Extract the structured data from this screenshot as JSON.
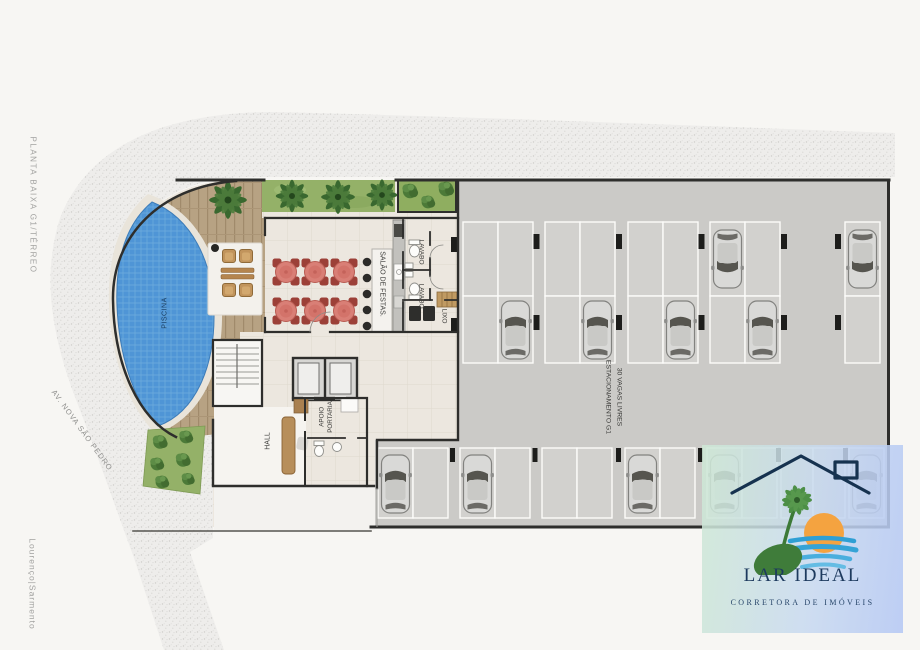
{
  "annotations": {
    "plan_title": "PLANTA BAIXA G1/TÉRREO",
    "credit": "Lourenço|Sarmento",
    "street_name": "AV. NOVA SÃO PEDRO"
  },
  "rooms": {
    "pool_label": "PISCINA",
    "party_room_label": "SALÃO DE FESTAS.",
    "lavabo1_label": "LAVABO",
    "lavabo2_label": "LAVABO",
    "trash_label": "LIXO",
    "concierge_label_line1": "APOIO",
    "concierge_label_line2": "PORTARIA",
    "hall_label": "HALL",
    "parking_label_line1": "ESTACIONAMENTO G1",
    "parking_label_line2": "30 VAGAS LIVRES"
  },
  "branding": {
    "company_name": "LAR IDEAL",
    "company_tagline": "CORRETORA DE IMÓVEIS"
  },
  "palette": {
    "pool_blue": "#4f95d6",
    "lawn_green": "#94b168",
    "deck_wood": "#b7a283",
    "parking_floor": "#cbcac7",
    "parking_space": "#d2d1ce",
    "table_red": "#d97f76",
    "wall_dark": "#2e2e2c",
    "sidewalk": "#eeedeb",
    "logo_navy": "#1d3a5e",
    "logo_sun": "#f4a340",
    "logo_wave": "#35a3d6",
    "logo_palm": "#4d8f46",
    "logo_bg_from": "#cfe9d6",
    "logo_bg_to": "#b7ccf2"
  }
}
